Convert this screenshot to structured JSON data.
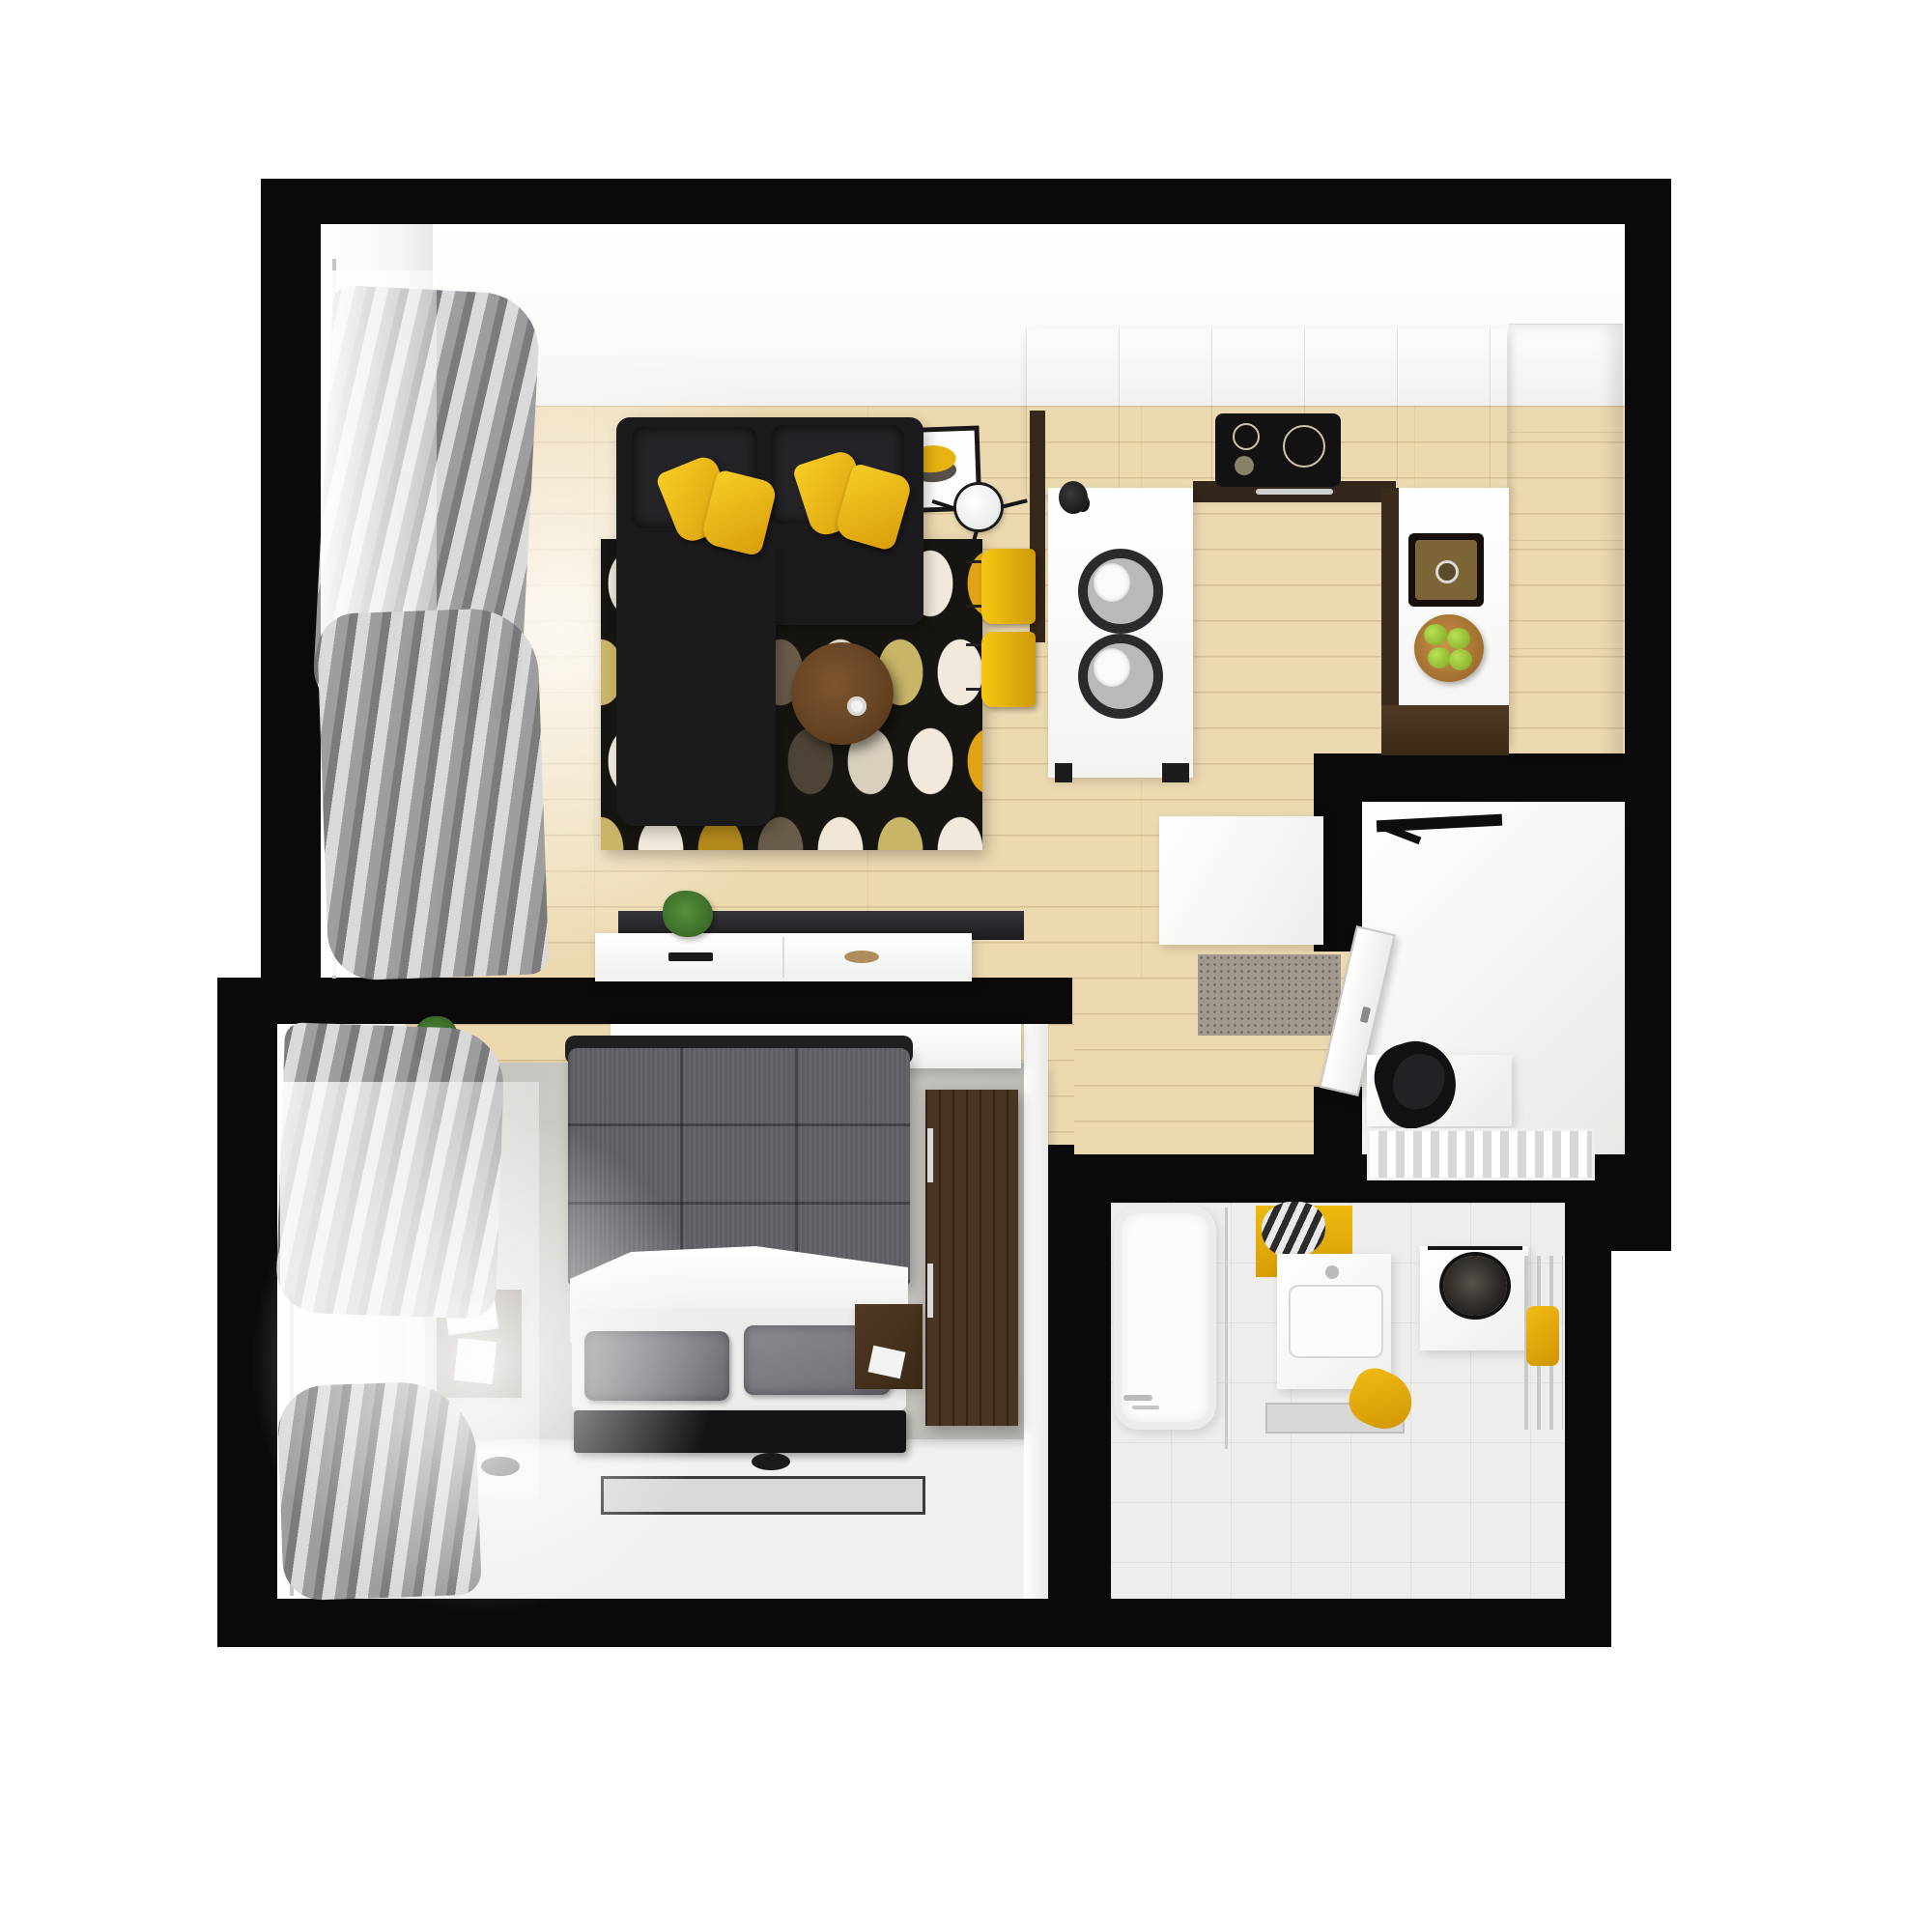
{
  "scene": {
    "title": "3D top-down floor plan of a small one-bedroom apartment",
    "view": "top-down axonometric render",
    "background": "white",
    "rooms_count": 5
  },
  "rooms": [
    {
      "id": "living",
      "name": "living-room",
      "floor": "light wood planks",
      "furniture": [
        "black corner sofa",
        "4 yellow pillows",
        "oval-pattern rug",
        "round wooden coffee table",
        "floor lamp",
        "tv",
        "white tv console",
        "plant",
        "3 framed prints",
        "gray curtains with window"
      ]
    },
    {
      "id": "kitchen",
      "name": "kitchen",
      "floor": "light wood planks",
      "furniture": [
        "u-shaped white counter",
        "induction cooktop",
        "brown sink",
        "fruit bowl with green apples",
        "breakfast bar with 2 place settings",
        "2 yellow bar stools",
        "tall white cabinets",
        "moka pot"
      ]
    },
    {
      "id": "hall",
      "name": "hallway",
      "floor": "light wood planks",
      "furniture": [
        "white wardrobe",
        "gray doormat"
      ]
    },
    {
      "id": "entry",
      "name": "entry-vestibule",
      "floor": "white",
      "furniture": [
        "entrance door",
        "coat rack",
        "white bench",
        "black jacket",
        "shoe rack"
      ]
    },
    {
      "id": "bedroom",
      "name": "bedroom",
      "floor": "white with wood strip and gray rug",
      "furniture": [
        "double bed with gray quilt",
        "white duvet",
        "2 gray pillows",
        "2 dark nightstands",
        "dark brown wardrobe",
        "white wall console",
        "floor mirror",
        "black foot runner",
        "curtains with window",
        "plant"
      ]
    },
    {
      "id": "bath",
      "name": "bathroom",
      "floor": "white tiles",
      "furniture": [
        "bathtub with shower",
        "vanity with basin",
        "toilet with dark round bowl",
        "chrome radiator",
        "yellow towels",
        "yellow accent tile",
        "striped towel"
      ]
    }
  ],
  "counts": {
    "framed_prints": 3,
    "sofa_pillows": 4,
    "bar_stools": 2,
    "place_settings": 2,
    "apples": 4,
    "bed_pillows": 2,
    "nightstands": 2
  },
  "palette": {
    "wall": "#0a0a0a",
    "wood": "#ecd9b0",
    "white": "#ffffff",
    "room": "#f5f5f4",
    "accent": "#f0b517",
    "sofa": "#1b1b1d",
    "bed": "#5d5d64",
    "brown": "#46321f",
    "tile": "#eeedeb",
    "curtain": "#97979a"
  }
}
